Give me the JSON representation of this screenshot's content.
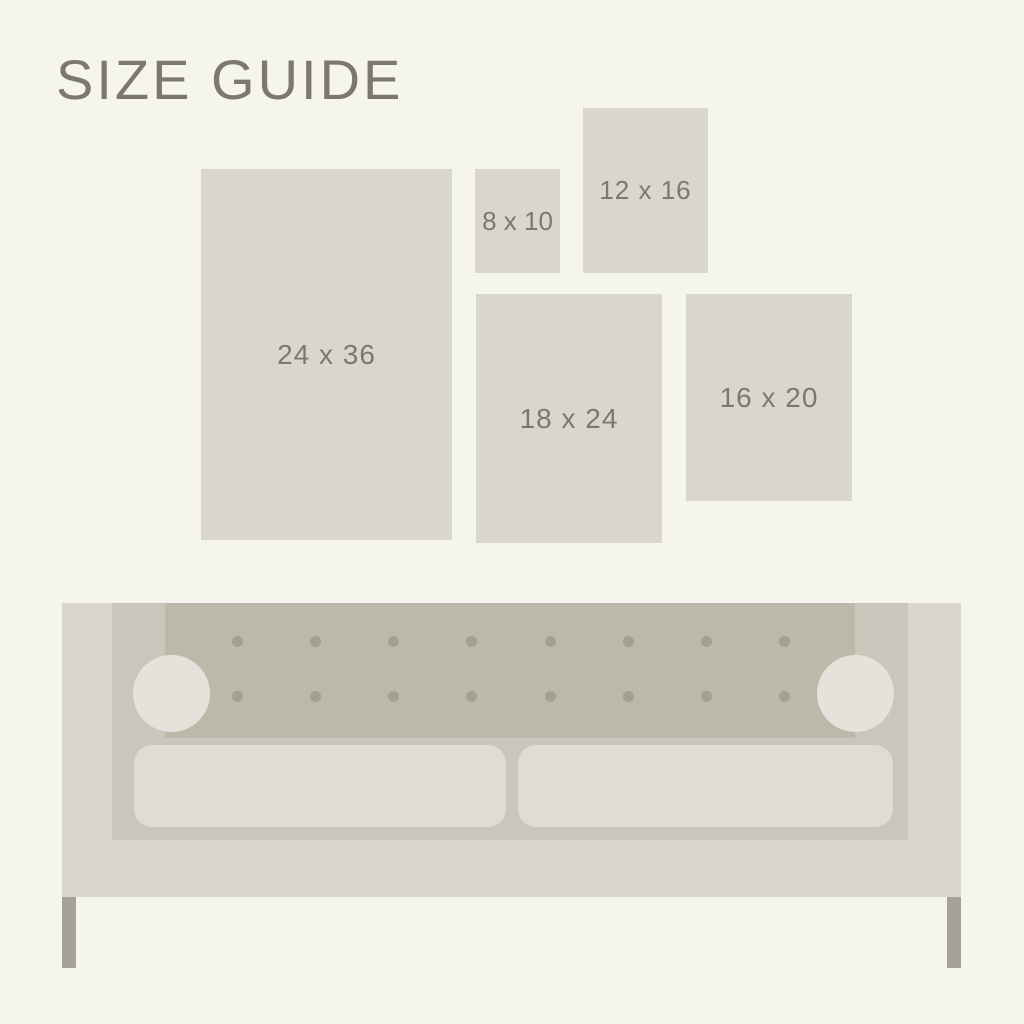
{
  "title": "SIZE GUIDE",
  "frames": [
    {
      "id": "24x36",
      "label": "24 x 36"
    },
    {
      "id": "8x10",
      "label": "8 x 10"
    },
    {
      "id": "12x16",
      "label": "12 x 16"
    },
    {
      "id": "18x24",
      "label": "18 x 24"
    },
    {
      "id": "16x20",
      "label": "16 x 20"
    }
  ],
  "illustration": {
    "name": "sofa",
    "tufting_button_count": 16,
    "seat_cushion_count": 2,
    "bolster_pillow_count": 2,
    "leg_count": 2
  },
  "colors": {
    "background": "#f5f4ed",
    "frame": "#d8d6cf",
    "text": "#7c786b",
    "sofa_body": "#d9d6ce",
    "sofa_inner": "#c9c6bb",
    "sofa_back": "#bcb9aa",
    "pillow": "#e5e2db",
    "button": "#a3a090",
    "cushion": "#dfdcd5",
    "leg": "#a6a296"
  }
}
